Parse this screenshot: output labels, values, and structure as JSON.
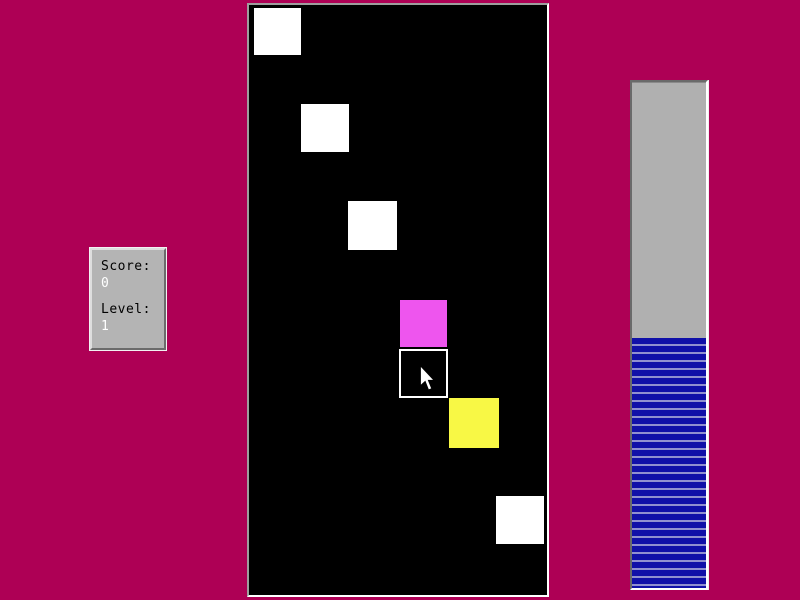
{
  "colors": {
    "background": "#ae0055",
    "field_bg": "#000000",
    "panel_bg": "#b4b4b4",
    "bar_trough": "#b0b0b0",
    "bar_stripe_dark": "#1010a8",
    "bar_stripe_light": "#9090d0",
    "block_white": "#ffffff",
    "block_magenta": "#ee55ee",
    "block_yellow": "#f8f845"
  },
  "scoreboard": {
    "score_label": "Score:",
    "score_value": "0",
    "level_label": "Level:",
    "level_value": "1"
  },
  "field": {
    "blocks": [
      {
        "x": 5,
        "y": 3,
        "size": 47,
        "color": "#ffffff"
      },
      {
        "x": 52,
        "y": 99,
        "size": 48,
        "color": "#ffffff"
      },
      {
        "x": 99,
        "y": 196,
        "size": 49,
        "color": "#ffffff"
      },
      {
        "x": 151,
        "y": 295,
        "size": 47,
        "color": "#ee55ee"
      },
      {
        "x": 200,
        "y": 393,
        "size": 50,
        "color": "#f8f845"
      },
      {
        "x": 247,
        "y": 491,
        "size": 48,
        "color": "#ffffff"
      }
    ],
    "cursor_cell": {
      "x": 150,
      "y": 344,
      "size": 49
    },
    "cursor": {
      "x": 170,
      "y": 361,
      "width": 16,
      "height": 26
    }
  },
  "progress": {
    "fill_percent": 49.4
  }
}
